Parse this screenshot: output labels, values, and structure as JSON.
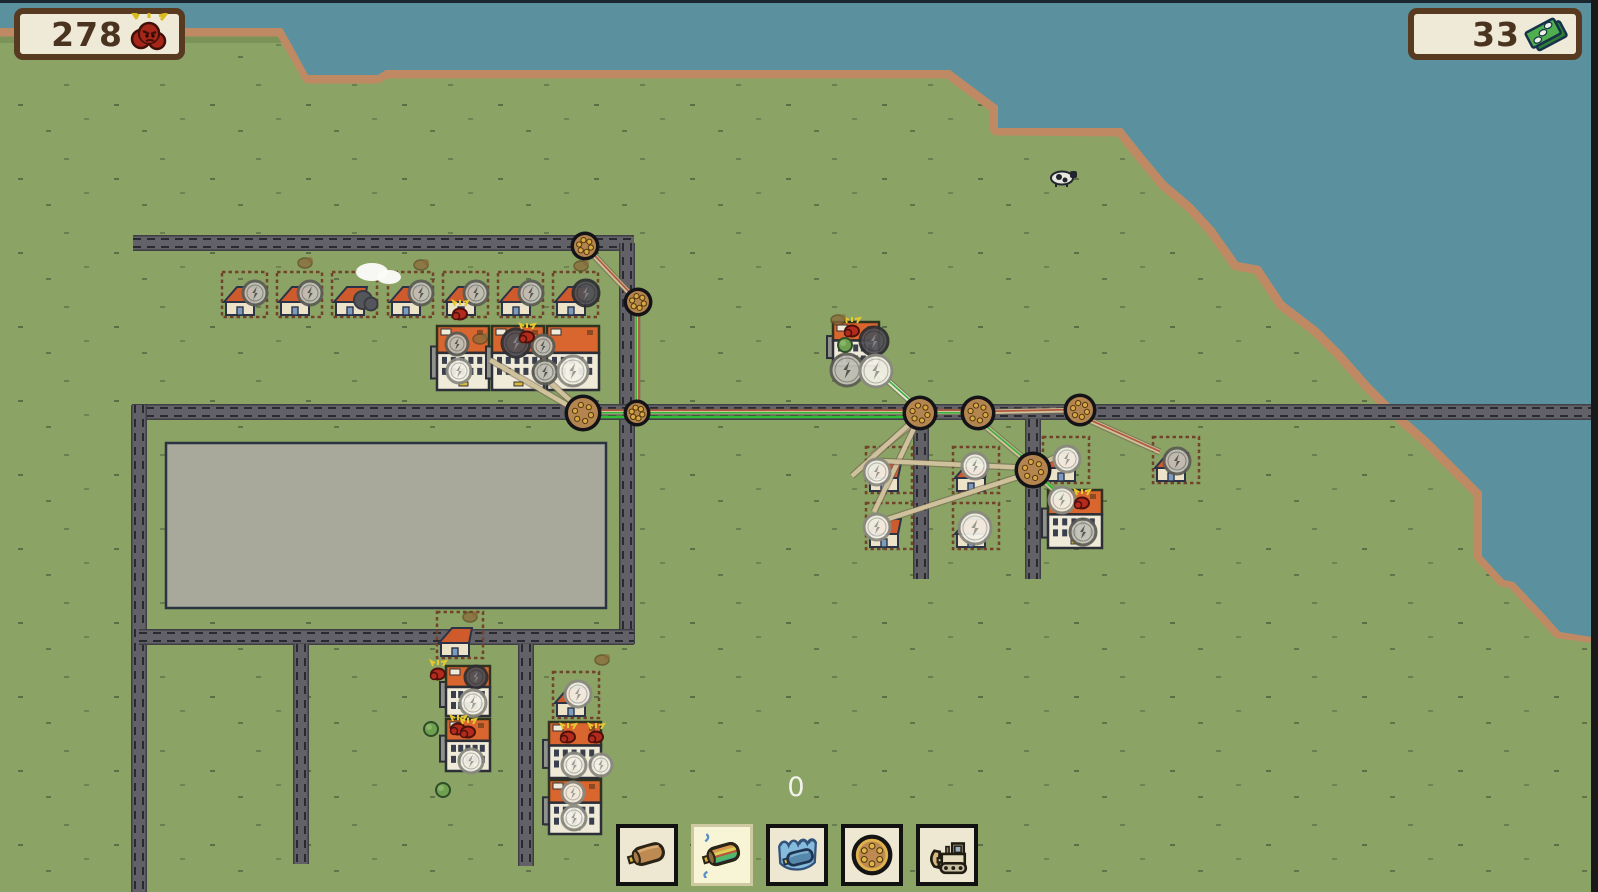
{
  "hud": {
    "left_counter": {
      "value": "278",
      "icon": "angry-creature-icon"
    },
    "right_counter": {
      "value": "33",
      "icon": "money-icon"
    },
    "build_counter": {
      "value": "0"
    }
  },
  "toolbar": {
    "buttons": [
      {
        "name": "tool-cable",
        "icon": "cable-icon",
        "selected": false
      },
      {
        "name": "tool-multi-cable",
        "icon": "multi-cable-icon",
        "selected": true
      },
      {
        "name": "tool-underwater-cable",
        "icon": "underwater-cable-icon",
        "selected": false
      },
      {
        "name": "tool-pole",
        "icon": "pole-icon",
        "selected": false
      },
      {
        "name": "tool-bulldozer",
        "icon": "bulldozer-icon",
        "selected": false
      }
    ]
  },
  "colors": {
    "grass": "#8ba465",
    "water": "#5b919f",
    "shore": "#bf8a63",
    "road": "#616167",
    "road_edge": "#3f4046",
    "road_dash": "#23232b",
    "pad_fill": "#a8a99b",
    "pad_border": "#2b3240",
    "pole_fill": "#b5854f",
    "pole_border": "#141418",
    "pole_dot": "#d9a743",
    "cable_base": "#cfc19b",
    "cable_light": "#e9e5d3",
    "cable_outline": "#6f6250",
    "strand_red": "#b2583e",
    "strand_green": "#38b23c",
    "green_wire": "#2fbe33",
    "house_roof": "#cf5a2c",
    "house_wall": "#ece3c9",
    "house_door": "#7b9cc0",
    "apt_top": "#d9652f",
    "apt_bottom": "#f0ead8",
    "creature_red": "#b22b1d",
    "creature_brown": "#8a6b3a",
    "counter_bg": "#efead7",
    "counter_border": "#583a21",
    "counter_text": "#4a3420"
  },
  "map": {
    "water_polygon": [
      0,
      0,
      1598,
      0,
      1598,
      638,
      1560,
      632,
      1544,
      614,
      1514,
      582,
      1504,
      580,
      1482,
      556,
      1482,
      492,
      1454,
      464,
      1430,
      440,
      1394,
      408,
      1370,
      384,
      1342,
      352,
      1318,
      328,
      1284,
      302,
      1260,
      266,
      1238,
      262,
      1214,
      228,
      1192,
      204,
      1166,
      182,
      1146,
      158,
      1122,
      128,
      998,
      128,
      998,
      106,
      950,
      70,
      386,
      70,
      378,
      75,
      308,
      75,
      290,
      42,
      282,
      28,
      0,
      28
    ],
    "coast_line": [
      0,
      29,
      282,
      29,
      291,
      44,
      309,
      76,
      377,
      76,
      386,
      71,
      949,
      71,
      997,
      107,
      997,
      128,
      1121,
      129,
      1145,
      159,
      1165,
      183,
      1191,
      205,
      1213,
      229,
      1237,
      263,
      1259,
      267,
      1283,
      303,
      1317,
      329,
      1341,
      353,
      1369,
      385,
      1393,
      409,
      1429,
      441,
      1453,
      465,
      1481,
      493,
      1481,
      555,
      1503,
      579,
      1513,
      581,
      1543,
      613,
      1559,
      631,
      1598,
      636
    ],
    "roads": [
      [
        133,
        243,
        634,
        243
      ],
      [
        627,
        243,
        627,
        644
      ],
      [
        132,
        412,
        1598,
        412
      ],
      [
        139,
        405,
        139,
        892
      ],
      [
        139,
        637,
        634,
        637
      ],
      [
        301,
        644,
        301,
        864
      ],
      [
        526,
        644,
        526,
        866
      ],
      [
        921,
        419,
        921,
        579
      ],
      [
        1033,
        419,
        1033,
        579
      ]
    ],
    "pad": [
      166,
      443,
      440,
      165
    ],
    "poles": [
      [
        585,
        246,
        11
      ],
      [
        638,
        302,
        11
      ],
      [
        583,
        413,
        15
      ],
      [
        637,
        413,
        10
      ],
      [
        920,
        413,
        14
      ],
      [
        978,
        413,
        14
      ],
      [
        1080,
        410,
        13
      ],
      [
        1033,
        470,
        15
      ]
    ],
    "cables": [
      {
        "p": [
          585,
          246,
          638,
          302
        ],
        "s": [
          "red"
        ]
      },
      {
        "p": [
          637,
          302,
          637,
          409
        ],
        "s": [
          "red",
          "green"
        ]
      },
      {
        "p": [
          583,
          412,
          918,
          412
        ],
        "s": [
          "red",
          "green"
        ]
      },
      {
        "p": [
          583,
          417,
          916,
          417
        ],
        "g": true
      },
      {
        "p": [
          920,
          412,
          976,
          412
        ],
        "s": [
          "red",
          "green"
        ]
      },
      {
        "p": [
          978,
          412,
          1078,
          410
        ],
        "s": [
          "red"
        ]
      },
      {
        "p": [
          581,
          410,
          534,
          368
        ],
        "s": []
      },
      {
        "p": [
          579,
          412,
          490,
          360
        ],
        "s": []
      },
      {
        "p": [
          878,
          372,
          916,
          406
        ],
        "s": [
          "green"
        ],
        "light": true
      },
      {
        "p": [
          918,
          420,
          872,
          456
        ],
        "s": []
      },
      {
        "p": [
          918,
          420,
          874,
          512
        ],
        "s": []
      },
      {
        "p": [
          914,
          420,
          852,
          476
        ],
        "s": []
      },
      {
        "p": [
          978,
          420,
          1028,
          462
        ],
        "s": [
          "green"
        ]
      },
      {
        "p": [
          1078,
          415,
          1160,
          452
        ],
        "s": [
          "red"
        ]
      },
      {
        "p": [
          1030,
          468,
          880,
          461
        ],
        "s": []
      },
      {
        "p": [
          1030,
          473,
          882,
          521
        ],
        "s": []
      },
      {
        "p": [
          1037,
          466,
          1060,
          455
        ],
        "s": []
      },
      {
        "p": [
          1037,
          474,
          1064,
          500
        ],
        "s": [
          "green"
        ]
      },
      {
        "p": [
          1040,
          476,
          1068,
          503
        ],
        "g": true
      }
    ],
    "houses": [
      {
        "plot": [
          222,
          272,
          45
        ],
        "icon": {
          "v": "gray",
          "x": 255,
          "y": 293,
          "r": 12
        }
      },
      {
        "plot": [
          277,
          272,
          45
        ],
        "icon": {
          "v": "gray",
          "x": 310,
          "y": 293,
          "r": 12
        }
      },
      {
        "plot": [
          332,
          272,
          45
        ],
        "icon": {
          "v": "storm",
          "x": 363,
          "y": 300,
          "r": 12
        }
      },
      {
        "plot": [
          388,
          272,
          45
        ],
        "icon": {
          "v": "gray",
          "x": 421,
          "y": 293,
          "r": 12
        }
      },
      {
        "plot": [
          443,
          272,
          45
        ],
        "icon": {
          "v": "gray",
          "x": 476,
          "y": 293,
          "r": 12
        }
      },
      {
        "plot": [
          498,
          272,
          45
        ],
        "icon": {
          "v": "gray",
          "x": 531,
          "y": 293,
          "r": 12
        }
      },
      {
        "plot": [
          553,
          272,
          45
        ],
        "icon": {
          "v": "dark",
          "x": 586,
          "y": 293,
          "r": 13
        }
      },
      {
        "plot": [
          866,
          447,
          46
        ],
        "icon": {
          "v": "white",
          "x": 877,
          "y": 472,
          "r": 13
        }
      },
      {
        "plot": [
          866,
          503,
          46
        ],
        "icon": {
          "v": "white",
          "x": 877,
          "y": 527,
          "r": 13
        }
      },
      {
        "plot": [
          953,
          447,
          46
        ],
        "icon": {
          "v": "white",
          "x": 975,
          "y": 466,
          "r": 13
        }
      },
      {
        "plot": [
          953,
          503,
          46
        ],
        "icon": {
          "v": "white",
          "x": 975,
          "y": 528,
          "r": 16
        }
      },
      {
        "plot": [
          1043,
          437,
          46
        ],
        "icon": {
          "v": "white",
          "x": 1067,
          "y": 459,
          "r": 13
        }
      },
      {
        "plot": [
          1153,
          437,
          46
        ],
        "icon": {
          "v": "gray",
          "x": 1177,
          "y": 461,
          "r": 13
        }
      },
      {
        "plot": [
          437,
          612,
          46
        ]
      },
      {
        "plot": [
          553,
          672,
          46
        ],
        "icon": {
          "v": "white",
          "x": 578,
          "y": 694,
          "r": 13
        }
      }
    ],
    "apartments": [
      [
        437,
        326,
        52,
        64
      ],
      [
        492,
        326,
        52,
        64
      ],
      [
        547,
        326,
        52,
        64
      ],
      [
        833,
        322,
        46,
        44
      ],
      [
        1048,
        490,
        54,
        58
      ],
      [
        446,
        666,
        44,
        50
      ],
      [
        446,
        719,
        44,
        52
      ],
      [
        549,
        722,
        52,
        56
      ],
      [
        549,
        780,
        52,
        54
      ]
    ],
    "rings": [
      [
        457,
        344,
        11,
        "gray"
      ],
      [
        516,
        343,
        14,
        "dark"
      ],
      [
        543,
        346,
        11,
        "gray"
      ],
      [
        459,
        371,
        12,
        "white"
      ],
      [
        545,
        372,
        12,
        "gray"
      ],
      [
        573,
        371,
        15,
        "white"
      ],
      [
        874,
        341,
        14,
        "dark"
      ],
      [
        847,
        370,
        16,
        "gray"
      ],
      [
        876,
        371,
        16,
        "white"
      ],
      [
        1062,
        500,
        13,
        "white"
      ],
      [
        1083,
        532,
        13,
        "gray"
      ],
      [
        476,
        677,
        11,
        "dark"
      ],
      [
        473,
        703,
        13,
        "white"
      ],
      [
        471,
        761,
        12,
        "white"
      ],
      [
        574,
        765,
        12,
        "white"
      ],
      [
        601,
        765,
        11,
        "white"
      ],
      [
        573,
        793,
        11,
        "white"
      ],
      [
        574,
        818,
        12,
        "white"
      ]
    ],
    "creatures_red": [
      [
        460,
        314
      ],
      [
        527,
        337
      ],
      [
        852,
        331
      ],
      [
        1082,
        503
      ],
      [
        438,
        674
      ],
      [
        458,
        729
      ],
      [
        468,
        732
      ],
      [
        568,
        737
      ],
      [
        596,
        737
      ]
    ],
    "creatures_brown": [
      [
        470,
        617
      ],
      [
        602,
        660
      ],
      [
        305,
        263
      ],
      [
        421,
        265
      ],
      [
        581,
        266
      ],
      [
        838,
        320
      ],
      [
        480,
        339
      ]
    ],
    "trees": [
      [
        845,
        345
      ],
      [
        431,
        729
      ],
      [
        443,
        790
      ]
    ],
    "cow": [
      1062,
      178
    ],
    "cloud": [
      380,
      276
    ]
  }
}
